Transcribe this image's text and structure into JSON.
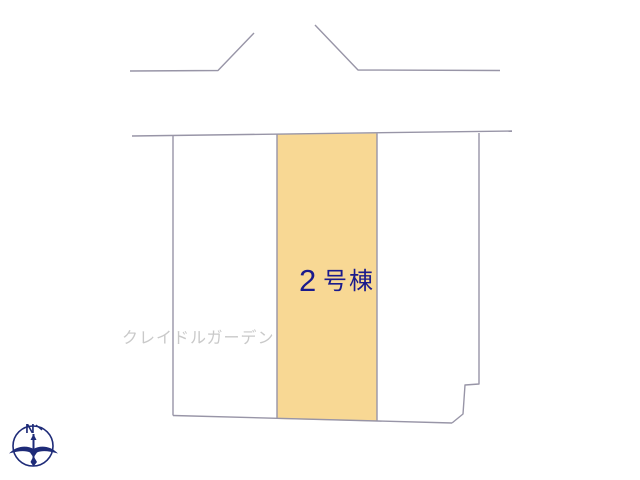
{
  "diagram": {
    "highlighted_lot": {
      "number": "2",
      "suffix": "号棟"
    },
    "watermark": "クレイドルガーデン",
    "compass": {
      "north_label": "N"
    }
  },
  "colors": {
    "background": "#FFFFFF",
    "lot_fill": "#F8D894",
    "boundary_line": "#9895A7",
    "lot_label_text": "#1A1A8C",
    "watermark_text": "#C9C9C9",
    "compass": "#1E2B78"
  }
}
